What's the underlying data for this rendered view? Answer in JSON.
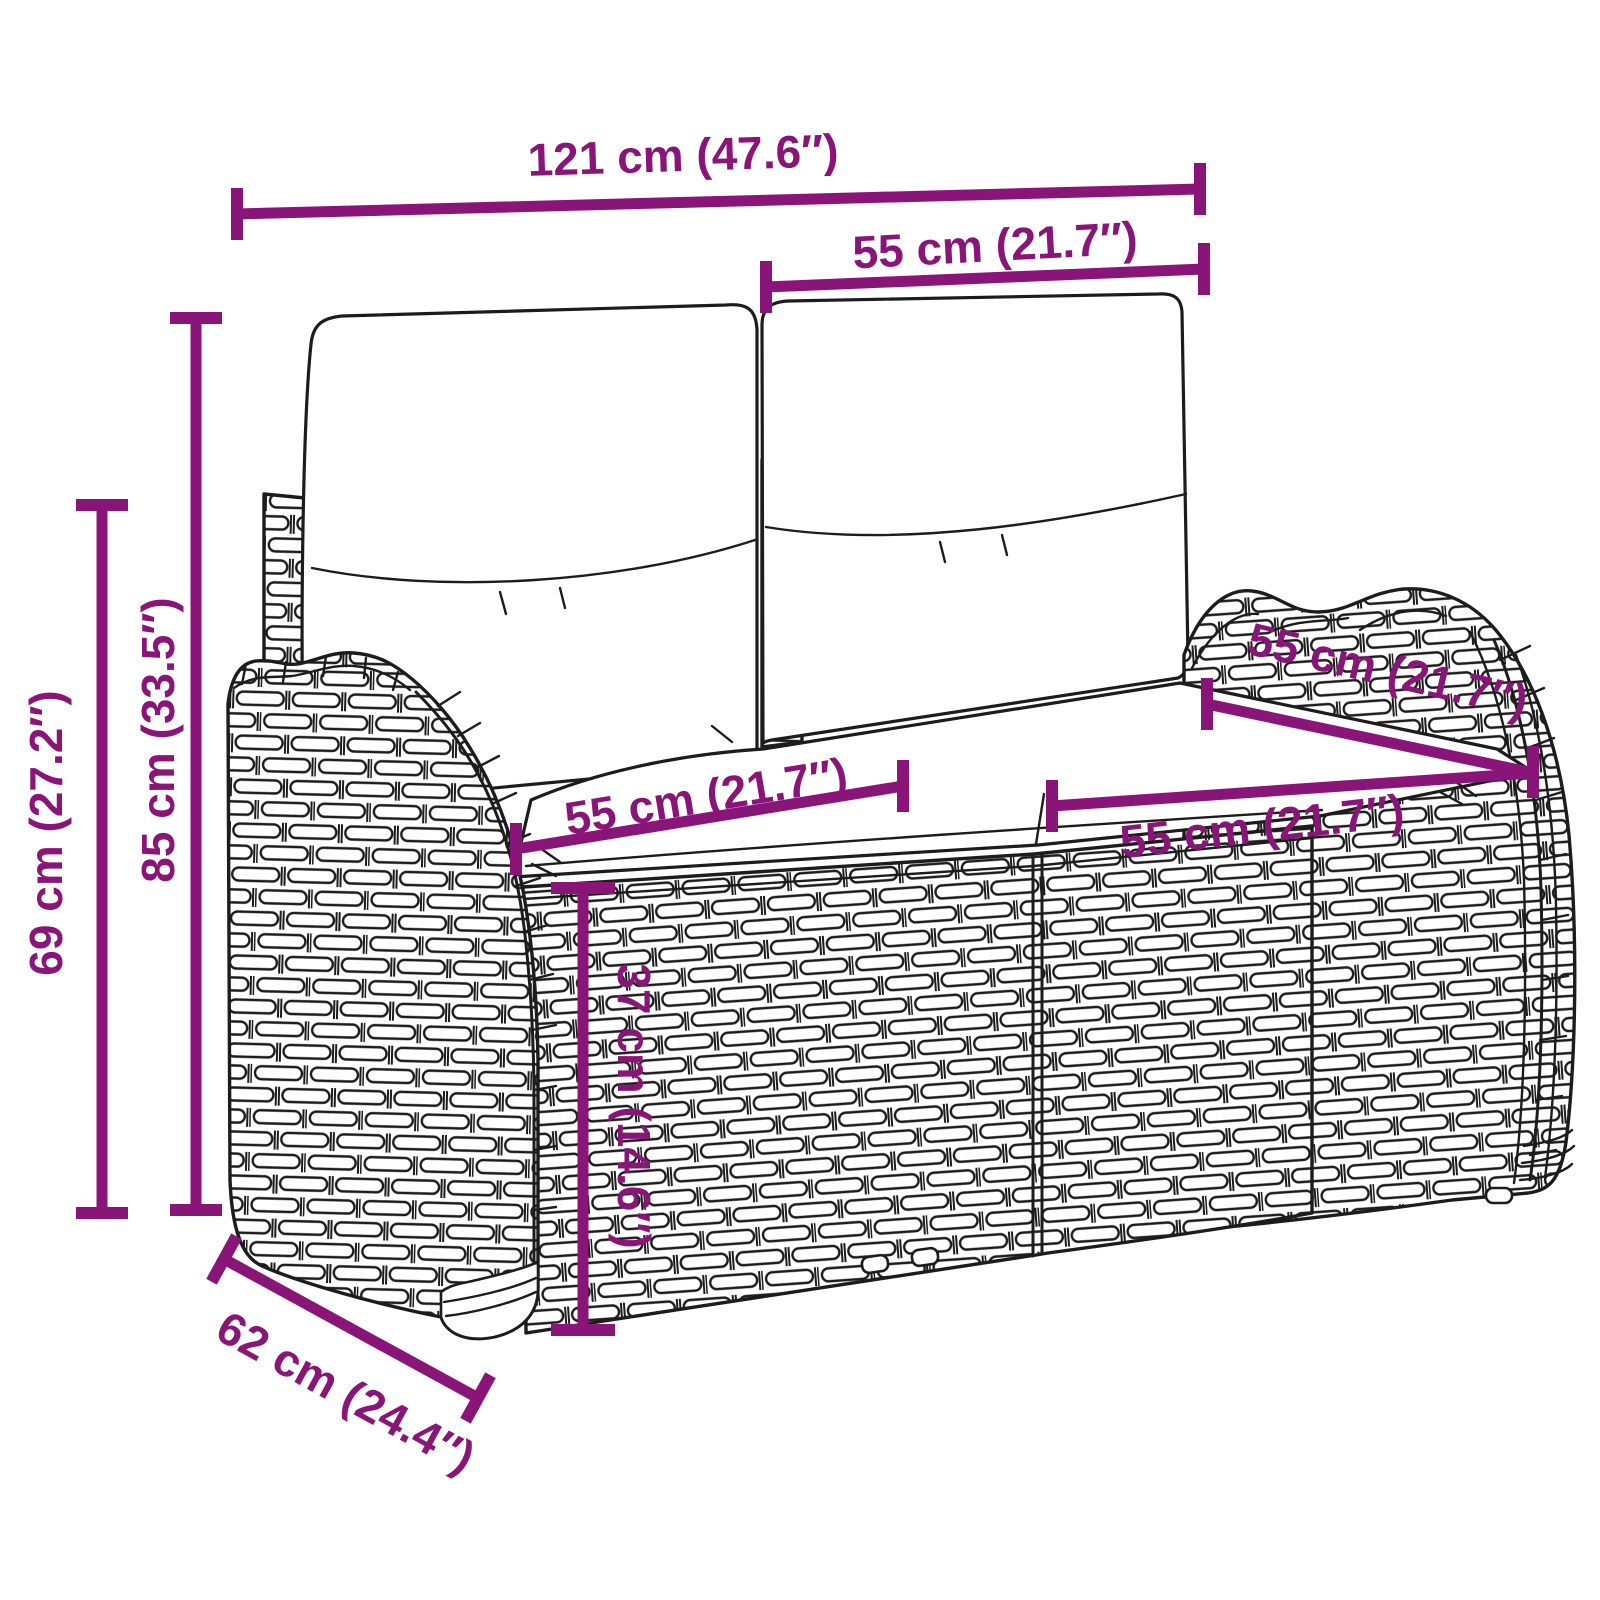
{
  "colors": {
    "dimension": "#8A1578",
    "line_art": "#1C1C1C",
    "background": "#FFFFFF"
  },
  "dimensions": {
    "overall_width": "121 cm (47.6″)",
    "back_cushion_width": "55 cm (21.7″)",
    "overall_height": "85 cm (33.5″)",
    "arm_height": "69 cm (27.2″)",
    "seat_left_width": "55 cm (21.7″)",
    "seat_right_width": "55 cm (21.7″)",
    "seat_depth": "55 cm (21.7″)",
    "seat_height": "37 cm (14.6″)",
    "overall_depth": "62 cm (24.4″)"
  }
}
